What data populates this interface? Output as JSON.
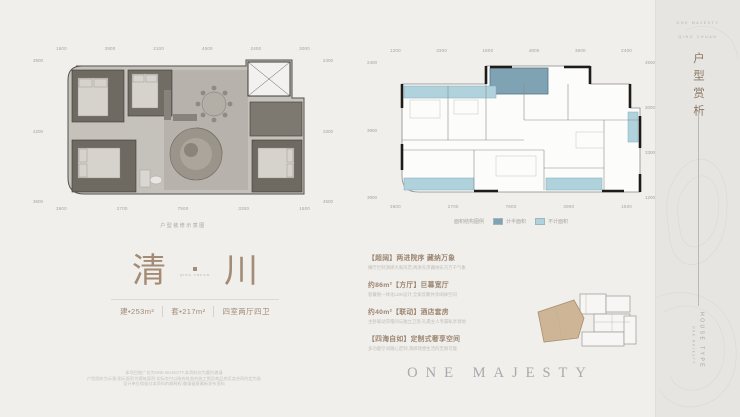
{
  "page": {
    "bg": "#f0efec",
    "sidebar_bg": "#e7e5e2",
    "accent": "#a38b75",
    "cyan": "#b0d2dd",
    "steel": "#80a3b4"
  },
  "title_block": {
    "char_left": "清",
    "char_right": "川",
    "separator_sub": "QING CHUAN",
    "specs": [
      "建•253m²",
      "套•217m²",
      "四室两厅四卫"
    ]
  },
  "features": [
    {
      "hl": "【超阔】两进院序 藏纳万象",
      "st": "横厅巨制演绎大家风范,两进礼序藏纳东方万千气象"
    },
    {
      "hl": "约86m²【方厅】巨幕宽厅",
      "st": "客餐厨一体化LDK设计,全家欢聚共享阔绰空间"
    },
    {
      "hl": "约40m²【联动】酒店套房",
      "st": "主卧联动衣帽间与独立卫浴,礼遇主人专属私享领地"
    },
    {
      "hl": "【四海自如】定制式奢享空间",
      "st": "多功能空间随心定制,演绎理想生活的无限可能"
    }
  ],
  "plans": {
    "left": {
      "caption": "户型装修示意图",
      "dims_top": [
        "1500",
        "3900",
        "2100",
        "4500",
        "2400",
        "3000"
      ],
      "dims_bottom": [
        "3600",
        "2700",
        "7500",
        "3300",
        "1500"
      ],
      "dims_left": [
        "3900",
        "4200",
        "3600"
      ],
      "dims_right": [
        "2400",
        "3300",
        "4500"
      ]
    },
    "right": {
      "dims_top": [
        "1200",
        "3300",
        "1800",
        "4800",
        "3600",
        "2400"
      ],
      "dims_bottom": [
        "3600",
        "2700",
        "7800",
        "3900",
        "1500"
      ],
      "dims_left": [
        "2400",
        "3900",
        "3900"
      ],
      "dims_right": [
        "4500",
        "3000",
        "3300",
        "1200"
      ],
      "legend_title": "面积结构图例",
      "legend_items": [
        {
          "label": "计半面积",
          "color": "#80a3b4"
        },
        {
          "label": "不计面积",
          "color": "#b0d2dd"
        }
      ]
    }
  },
  "brand": {
    "wordmark": "ONE MAJESTY"
  },
  "disclaimer": [
    "本项目推广名为ONE MAJESTY,本资料仅为要约邀请",
    "户型图仅为示意,图示面积为建筑面积,实际交付以政府批准的施工图及商品房买卖合同约定为准",
    "设计单位保留对本资料的解释权,敬请留意最新发布资料"
  ],
  "sidebar": {
    "top_lines": [
      "ONE MAJESTY",
      "·",
      "QING CHUAN"
    ],
    "vertical_title": "户型赏析",
    "bottom_main": "HOUSE TYPE",
    "bottom_sub": "ONE MAJESTY"
  }
}
